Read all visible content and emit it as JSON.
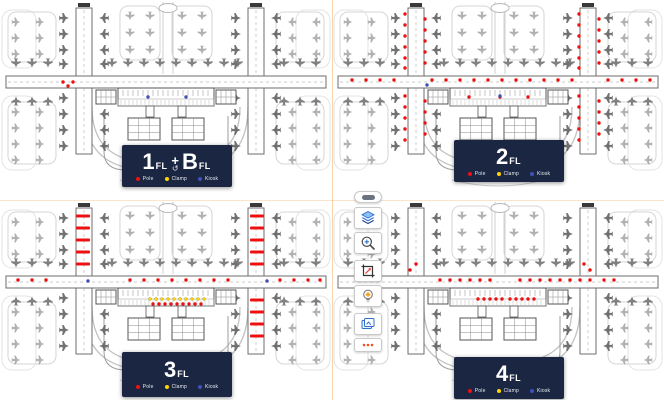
{
  "floors": [
    {
      "name": "1FL + BFL",
      "primary": "1",
      "primary_suffix": "FL",
      "separator": "+",
      "swap_icon": "↺",
      "secondary": "B",
      "secondary_suffix": "FL",
      "markers": {
        "poles": [
          [
            63,
            82
          ],
          [
            68,
            86
          ],
          [
            73,
            82
          ]
        ],
        "clamps": [],
        "kiosks": [
          [
            148,
            97
          ],
          [
            186,
            97
          ]
        ],
        "pole_bars": []
      }
    },
    {
      "name": "2FL",
      "primary": "2",
      "primary_suffix": "FL",
      "markers": {
        "poles": [
          [
            20,
            80
          ],
          [
            34,
            80
          ],
          [
            48,
            80
          ],
          [
            62,
            80
          ],
          [
            100,
            80
          ],
          [
            114,
            80
          ],
          [
            128,
            80
          ],
          [
            142,
            80
          ],
          [
            156,
            80
          ],
          [
            170,
            80
          ],
          [
            184,
            80
          ],
          [
            198,
            80
          ],
          [
            212,
            80
          ],
          [
            226,
            80
          ],
          [
            240,
            80
          ],
          [
            276,
            80
          ],
          [
            290,
            80
          ],
          [
            304,
            80
          ],
          [
            318,
            80
          ],
          [
            73,
            14
          ],
          [
            73,
            25
          ],
          [
            73,
            36
          ],
          [
            73,
            47
          ],
          [
            73,
            58
          ],
          [
            73,
            68
          ],
          [
            93,
            19
          ],
          [
            93,
            30
          ],
          [
            93,
            41
          ],
          [
            93,
            52
          ],
          [
            93,
            63
          ],
          [
            73,
            96
          ],
          [
            73,
            107
          ],
          [
            73,
            118
          ],
          [
            73,
            129
          ],
          [
            73,
            140
          ],
          [
            93,
            101
          ],
          [
            93,
            112
          ],
          [
            93,
            123
          ],
          [
            93,
            134
          ],
          [
            247,
            14
          ],
          [
            247,
            25
          ],
          [
            247,
            36
          ],
          [
            247,
            47
          ],
          [
            247,
            58
          ],
          [
            247,
            68
          ],
          [
            267,
            19
          ],
          [
            267,
            30
          ],
          [
            267,
            41
          ],
          [
            267,
            52
          ],
          [
            267,
            63
          ],
          [
            247,
            96
          ],
          [
            247,
            107
          ],
          [
            247,
            118
          ],
          [
            247,
            129
          ],
          [
            247,
            140
          ],
          [
            267,
            101
          ],
          [
            267,
            112
          ],
          [
            267,
            123
          ],
          [
            267,
            134
          ],
          [
            137,
            97
          ],
          [
            168,
            97
          ],
          [
            196,
            97
          ]
        ],
        "clamps": [],
        "kiosks": [
          [
            95,
            85
          ],
          [
            168,
            96
          ]
        ],
        "pole_bars": []
      }
    },
    {
      "name": "3FL",
      "primary": "3",
      "primary_suffix": "FL",
      "markers": {
        "poles": [
          [
            18,
            80
          ],
          [
            32,
            80
          ],
          [
            46,
            80
          ],
          [
            130,
            80
          ],
          [
            144,
            80
          ],
          [
            158,
            80
          ],
          [
            172,
            80
          ],
          [
            186,
            80
          ],
          [
            200,
            80
          ],
          [
            214,
            80
          ],
          [
            228,
            80
          ],
          [
            280,
            80
          ],
          [
            294,
            80
          ],
          [
            308,
            80
          ],
          [
            320,
            80
          ],
          [
            153,
            104
          ],
          [
            159,
            104
          ],
          [
            165,
            104
          ],
          [
            171,
            104
          ],
          [
            177,
            104
          ],
          [
            183,
            104
          ],
          [
            189,
            104
          ],
          [
            195,
            104
          ],
          [
            201,
            104
          ]
        ],
        "clamps": [
          [
            150,
            99
          ],
          [
            156,
            99
          ],
          [
            162,
            99
          ],
          [
            168,
            99
          ],
          [
            174,
            99
          ],
          [
            180,
            99
          ],
          [
            186,
            99
          ],
          [
            192,
            99
          ],
          [
            198,
            99
          ],
          [
            204,
            99
          ]
        ],
        "kiosks": [
          [
            88,
            81
          ],
          [
            267,
            81
          ]
        ],
        "pole_bars": [
          [
            83,
            16
          ],
          [
            83,
            28
          ],
          [
            83,
            40
          ],
          [
            83,
            52
          ],
          [
            83,
            64
          ],
          [
            257,
            16
          ],
          [
            257,
            28
          ],
          [
            257,
            40
          ],
          [
            257,
            52
          ],
          [
            257,
            64
          ],
          [
            257,
            100
          ],
          [
            257,
            112
          ],
          [
            257,
            124
          ],
          [
            257,
            136
          ]
        ]
      }
    },
    {
      "name": "4FL",
      "primary": "4",
      "primary_suffix": "FL",
      "markers": {
        "poles": [
          [
            108,
            80
          ],
          [
            118,
            80
          ],
          [
            128,
            80
          ],
          [
            138,
            80
          ],
          [
            148,
            80
          ],
          [
            158,
            80
          ],
          [
            188,
            80
          ],
          [
            198,
            80
          ],
          [
            208,
            80
          ],
          [
            218,
            80
          ],
          [
            228,
            80
          ],
          [
            238,
            80
          ],
          [
            248,
            80
          ],
          [
            258,
            80
          ],
          [
            272,
            80
          ],
          [
            282,
            80
          ],
          [
            78,
            70
          ],
          [
            84,
            64
          ],
          [
            252,
            64
          ],
          [
            258,
            70
          ],
          [
            146,
            99
          ],
          [
            152,
            99
          ],
          [
            158,
            99
          ],
          [
            164,
            99
          ],
          [
            170,
            99
          ],
          [
            178,
            99
          ],
          [
            184,
            99
          ],
          [
            190,
            99
          ],
          [
            196,
            99
          ],
          [
            202,
            99
          ]
        ],
        "clamps": [],
        "kiosks": [],
        "pole_bars": []
      }
    }
  ],
  "legend": {
    "items": [
      {
        "label": "Pole",
        "color": "#ee1111"
      },
      {
        "label": "Clamp",
        "color": "#ffd400"
      },
      {
        "label": "Kiosk",
        "color": "#3f51b5"
      }
    ]
  },
  "colors": {
    "floor_panel": "#1b2742",
    "panel_text": "#ffffff"
  },
  "toolbar": {
    "buttons": [
      {
        "name": "collapse-handle",
        "icon": "drag-handle"
      },
      {
        "name": "layers-button",
        "icon": "layers"
      },
      {
        "name": "zoom-in-button",
        "icon": "zoom-in-magnifier"
      },
      {
        "name": "measure-button",
        "icon": "measure-crop-arrow"
      },
      {
        "name": "highlight-button",
        "icon": "lightbulb"
      },
      {
        "name": "gallery-button",
        "icon": "image-frames"
      },
      {
        "name": "more-button",
        "icon": "ellipsis-dots"
      }
    ]
  }
}
